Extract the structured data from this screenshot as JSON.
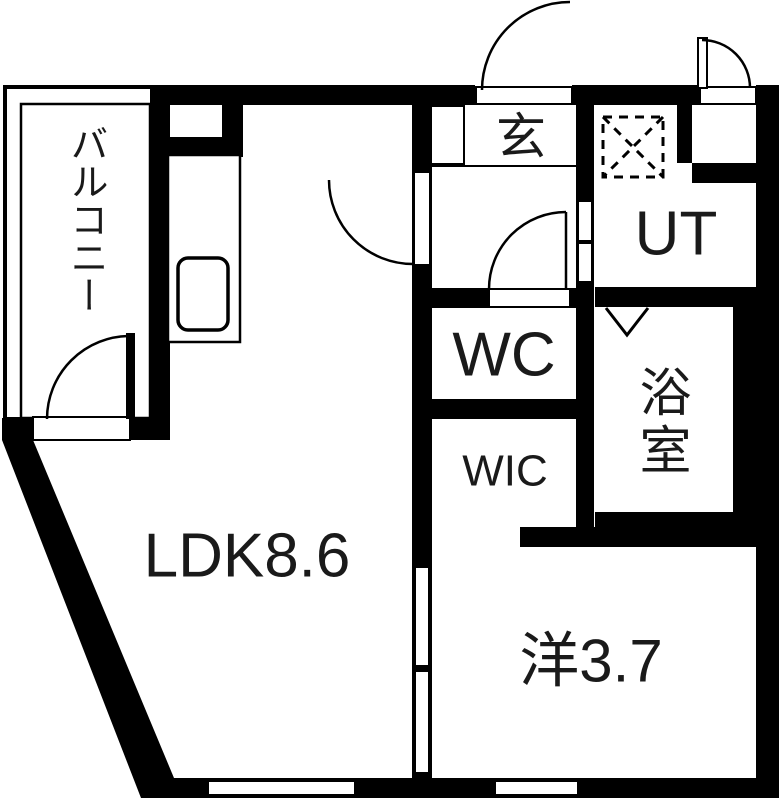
{
  "floorplan": {
    "type": "japanese-apartment-floor-plan",
    "labels": {
      "balcony": "バルコニー",
      "entrance": "玄",
      "utility": "UT",
      "toilet": "WC",
      "bath": "浴室",
      "walk_in_closet": "WIC",
      "living_dining_kitchen": "LDK8.6",
      "western_room": "洋3.7"
    },
    "colors": {
      "wall": "#000000",
      "floor": "#ffffff"
    }
  }
}
